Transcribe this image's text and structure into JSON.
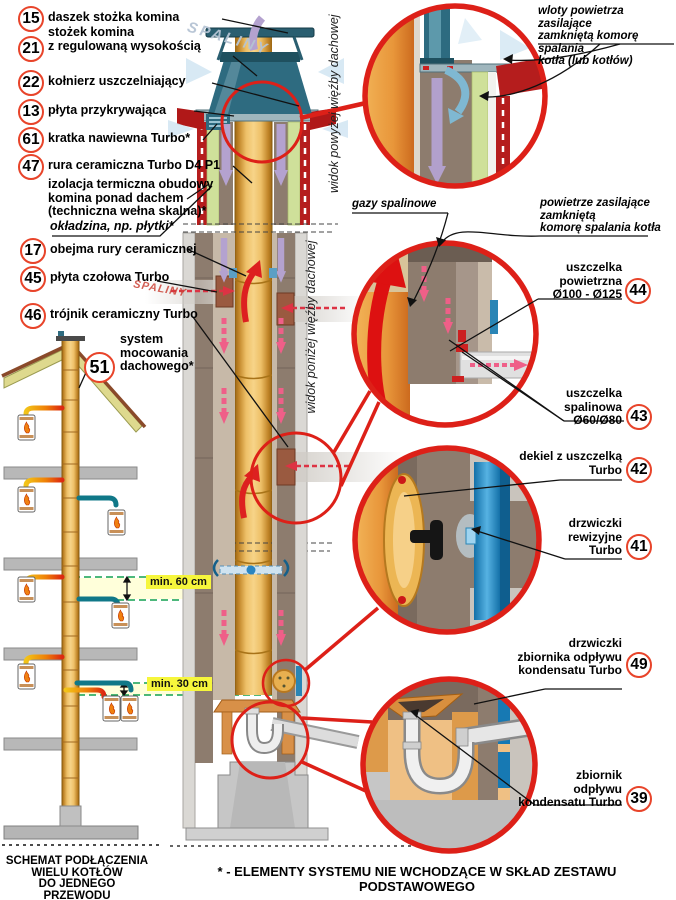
{
  "left_callouts": [
    {
      "num": "15",
      "label": "daszek stożka komina"
    },
    {
      "num": "21",
      "label": "stożek komina\nz regulowaną wysokością"
    },
    {
      "num": "22",
      "label": "kołnierz uszczelniający"
    },
    {
      "num": "13",
      "label": "płyta przykrywająca"
    },
    {
      "num": "61",
      "label": "kratka nawiewna Turbo*"
    },
    {
      "num": "47",
      "label": "rura ceramiczna Turbo D4 P1"
    },
    {
      "num": "17",
      "label": "obejma rury ceramicznej"
    },
    {
      "num": "45",
      "label": "płyta czołowa Turbo"
    },
    {
      "num": "46",
      "label": "trójnik ceramiczny Turbo"
    },
    {
      "num": "51",
      "label": "system\nmocowania\ndachowego*"
    }
  ],
  "plain_notes": [
    {
      "text": "izolacja termiczna obudowy\nkomina ponad dachem\n(techniczna wełna skalna)*"
    },
    {
      "text": "okładzina, np. płytki*"
    }
  ],
  "right_callouts": [
    {
      "num": "44",
      "label": "uszczelka\npowietrzna\nØ100 - Ø125"
    },
    {
      "num": "43",
      "label": "uszczelka\nspalinowa\nØ60/Ø80"
    },
    {
      "num": "42",
      "label": "dekiel z uszczelką\nTurbo"
    },
    {
      "num": "41",
      "label": "drzwiczki\nrewizyjne\nTurbo"
    },
    {
      "num": "49",
      "label": "drzwiczki\nzbiornika odpływu\nkondensatu Turbo"
    },
    {
      "num": "39",
      "label": "zbiornik\nodpływu\nkondensatu Turbo"
    }
  ],
  "flow_notes": {
    "wloty": "wloty powietrza zasilające\nzamkniętą komorę spalania\nkotła (lub kotłów)",
    "gazy": "gazy spalinowe",
    "powietrze": "powietrze zasilające\nzamkniętą\nkomorę spalania kotła"
  },
  "view_labels": {
    "above": "widok powyżej więźby dachowej",
    "below": "widok poniżej więźby dachowej"
  },
  "watermark": "SPALINY",
  "dimensions": {
    "d60": "min. 60 cm",
    "d30": "min. 30 cm"
  },
  "footer": {
    "caption": "SCHEMAT PODŁĄCZENIA\nWIELU KOTŁÓW\nDO JEDNEGO\nPRZEWODU SPALINOWEGO",
    "note": "* - ELEMENTY SYSTEMU NIE WCHODZĄCE W SKŁAD ZESTAWU PODSTAWOWEGO"
  },
  "colors": {
    "accent_red": "#dd2018",
    "pipe_orange": "#eab45c",
    "door_blue": "#1779b3",
    "insulation_green": "#cfe09a",
    "highlight_yellow": "#f6f63c"
  }
}
